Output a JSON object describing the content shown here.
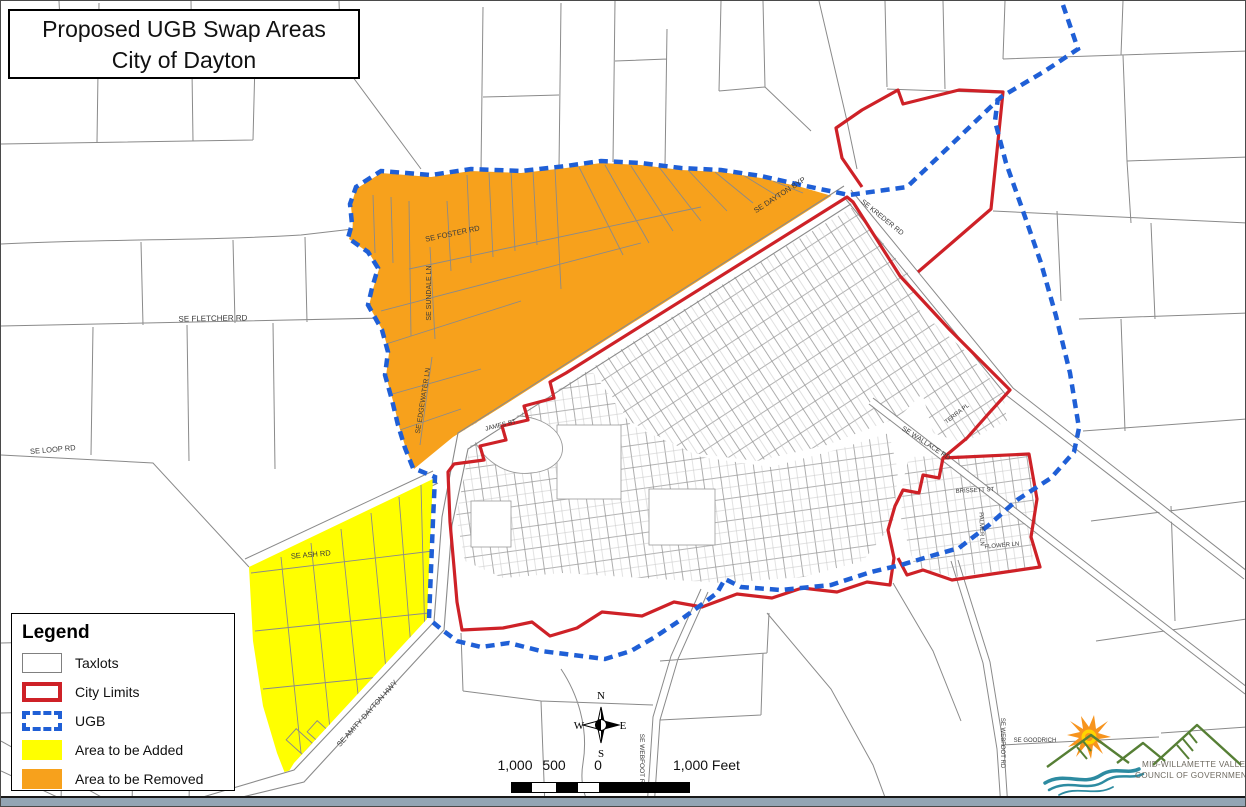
{
  "title": {
    "line1": "Proposed UGB Swap Areas",
    "line2": "City of Dayton"
  },
  "legend": {
    "title": "Legend",
    "items": [
      {
        "label": "Taxlots",
        "swatch": "taxlots"
      },
      {
        "label": "City Limits",
        "swatch": "city-limits"
      },
      {
        "label": "UGB",
        "swatch": "ugb"
      },
      {
        "label": "Area to be Added",
        "swatch": "added"
      },
      {
        "label": "Area to be Removed",
        "swatch": "removed"
      }
    ]
  },
  "compass": {
    "n": "N",
    "s": "S",
    "e": "E",
    "w": "W"
  },
  "scale_bar": {
    "labels": [
      "1,000",
      "500",
      "0",
      "1,000 Feet"
    ]
  },
  "logo": {
    "org_line1": "MID-WILLAMETTE VALLEY",
    "org_line2": "COUNCIL OF GOVERNMENTS"
  },
  "colors": {
    "area_added": "#FFFF00",
    "area_removed": "#F7A11C",
    "city_limits": "#CE2127",
    "ugb": "#1F5FD6",
    "taxlot_line": "#8a8a8a"
  },
  "map_labels": [
    {
      "text": "SE FLETCHER RD",
      "x": 212,
      "y": 320,
      "rot": -1
    },
    {
      "text": "SE FOSTER RD",
      "x": 452,
      "y": 235,
      "rot": -12
    },
    {
      "text": "SE SUNDALE LN",
      "x": 430,
      "y": 292,
      "rot": -90
    },
    {
      "text": "SE EDGEWATER LN",
      "x": 424,
      "y": 400,
      "rot": -81
    },
    {
      "text": "SE LOOP RD",
      "x": 52,
      "y": 451,
      "rot": -5
    },
    {
      "text": "SE ASH RD",
      "x": 310,
      "y": 556,
      "rot": -5
    },
    {
      "text": "SE AMITY DAYTON HWY",
      "x": 368,
      "y": 714,
      "rot": -48
    },
    {
      "text": "SE DAYTON BYP",
      "x": 780,
      "y": 196,
      "rot": -33
    },
    {
      "text": "SE KREDER RD",
      "x": 880,
      "y": 218,
      "rot": 39
    },
    {
      "text": "SE WALLACE RD",
      "x": 924,
      "y": 444,
      "rot": 33
    },
    {
      "text": "JAMES ST",
      "x": 500,
      "y": 426,
      "rot": -14
    },
    {
      "text": "BRISSETT ST",
      "x": 974,
      "y": 491,
      "rot": -3
    },
    {
      "text": "PALMER LN",
      "x": 979,
      "y": 528,
      "rot": 88
    },
    {
      "text": "SE WEBFOOT RD",
      "x": 639,
      "y": 760,
      "rot": 90
    },
    {
      "text": "SE WEBFOOT RD",
      "x": 1000,
      "y": 742,
      "rot": 90
    },
    {
      "text": "SE GOODRICH",
      "x": 1034,
      "y": 741,
      "rot": 0
    },
    {
      "text": "FLOWER LN",
      "x": 1001,
      "y": 546,
      "rot": -5
    },
    {
      "text": "TERRA PL",
      "x": 957,
      "y": 414,
      "rot": -38
    }
  ]
}
